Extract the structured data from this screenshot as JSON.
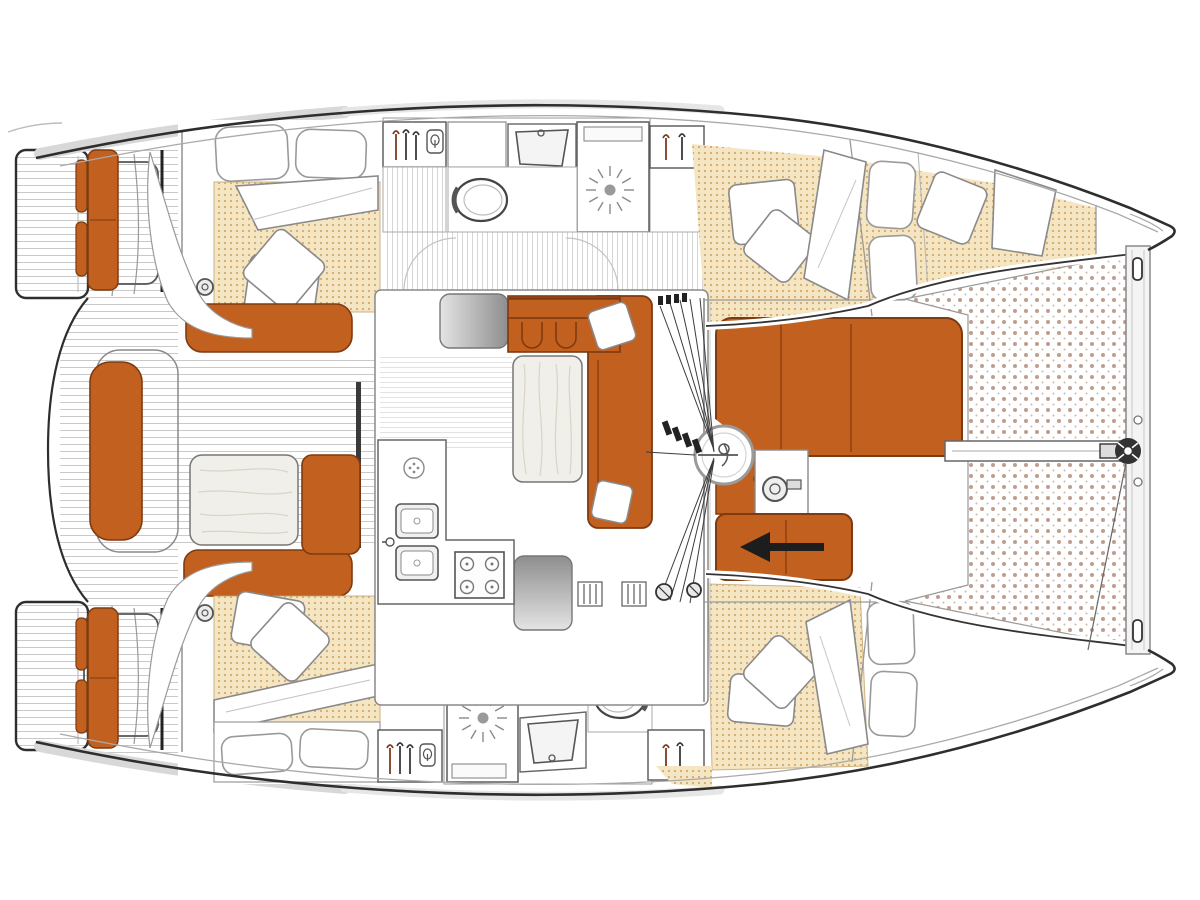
{
  "plan": {
    "type": "catamaran-deck-and-interior-floor-plan",
    "orientation": "bow-right-stern-left",
    "text_labels": []
  },
  "palette": {
    "ink": "#2e2e2e",
    "line": "#8a8a8a",
    "soft": "#bdbdbd",
    "orange": "#c2601f",
    "orange-line": "#7e3a10",
    "beige": "#f4e5c3",
    "beige-dot": "#d8a96b",
    "tramp-dot": "#bd9e8e",
    "plank": "#c9c9c9",
    "stripe": "#d6d6d6",
    "steel-dark": "#8e8e8e",
    "steel-light": "#e4e4e4",
    "wood": "#f1efe9",
    "wood-grain": "#d9d4c6",
    "roof": "#d8d8d8",
    "white": "#ffffff",
    "arrow": "#1d1d1d"
  },
  "icons": [
    "hanger-icon",
    "wetsuit-icon",
    "toilet-icon",
    "sink-icon",
    "shower-drain-icon",
    "stove-burner-icon",
    "vent-icon",
    "mast-icon",
    "windlass-icon",
    "winch-icon",
    "clutch-icon",
    "anchor-roller-icon",
    "direction-arrow-icon"
  ],
  "patterns": {
    "plank_spacing_px": 7,
    "stripe_spacing_px": 5,
    "mattress_dot_grid_px": 6,
    "trampoline_dot_grid_px": 11
  }
}
